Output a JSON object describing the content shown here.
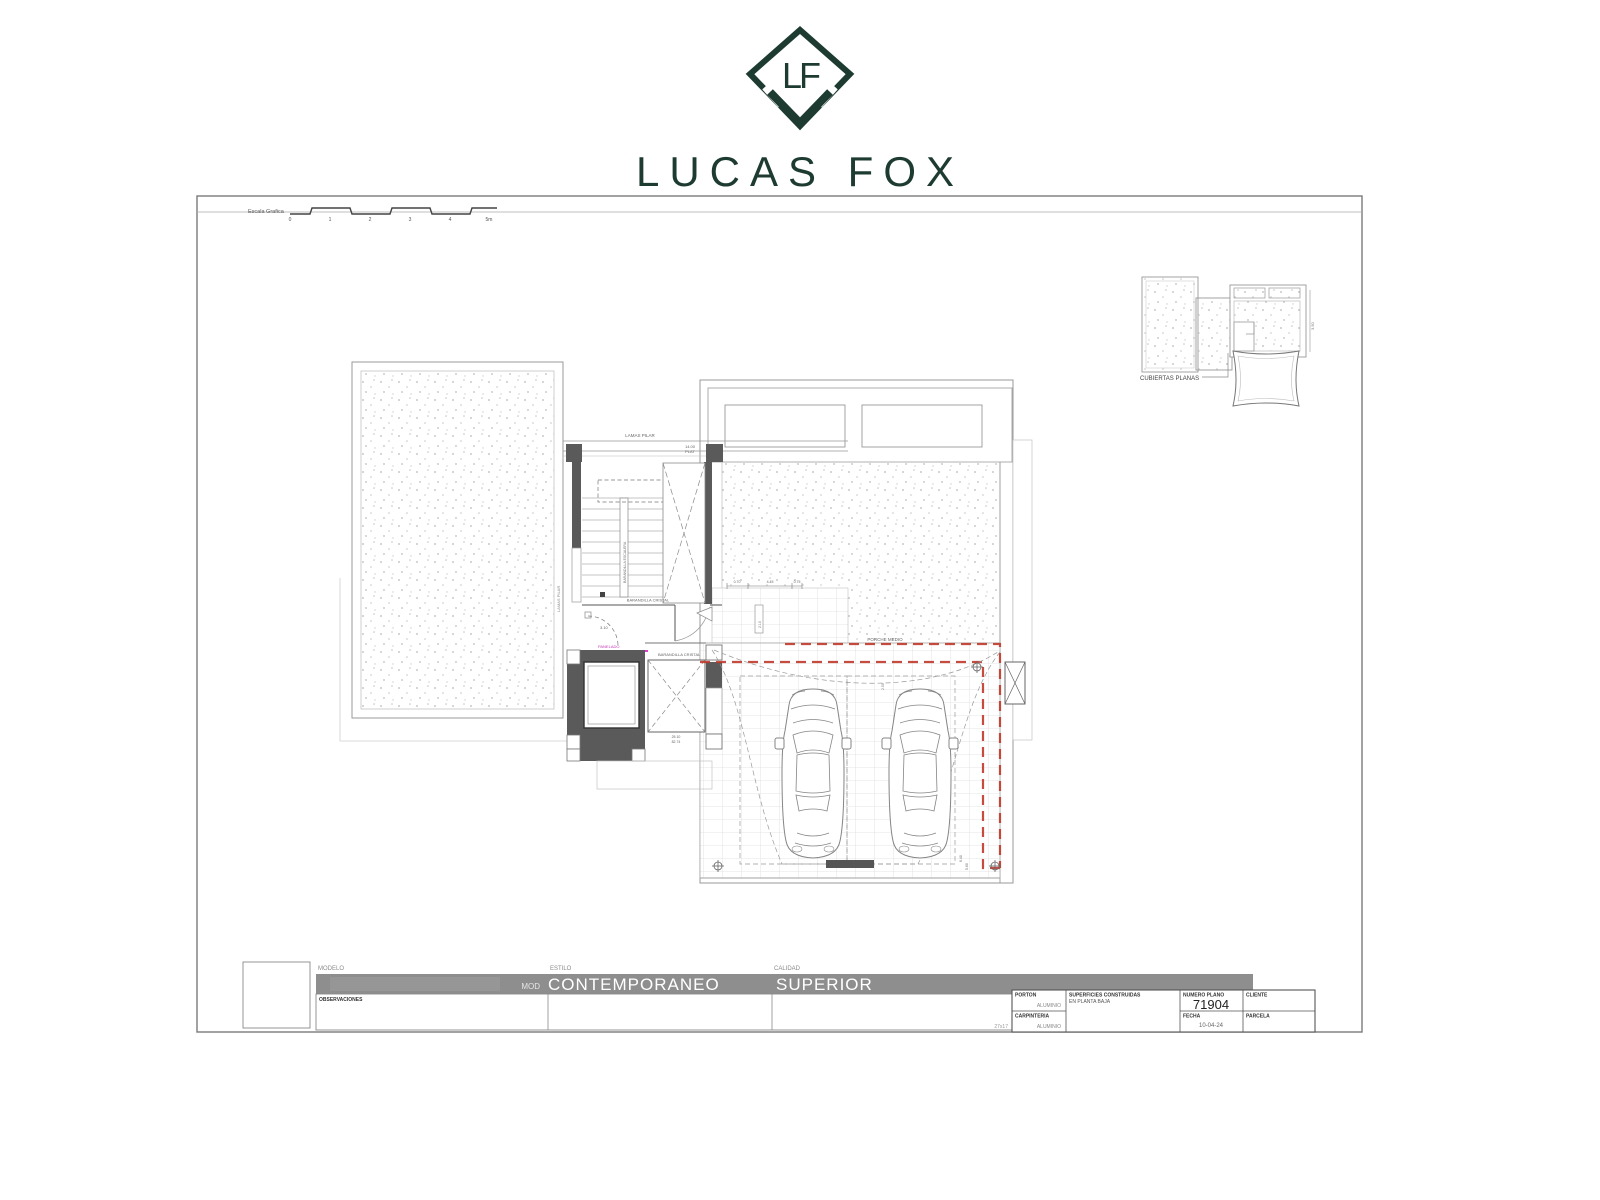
{
  "logo": {
    "monogram": "LF",
    "brand": "LUCAS FOX",
    "tagline": "A Dils company",
    "color": "#1d3b31"
  },
  "scale_bar": {
    "label": "Escala Grafica",
    "ticks": [
      "0",
      "1",
      "2",
      "3",
      "4",
      "5m"
    ]
  },
  "roof_inset": {
    "label": "CUBIERTAS PLANAS",
    "dim": "3.50"
  },
  "plan": {
    "lamas_pilar_top": "LAMAS PILAR",
    "plat_dim": "14.00",
    "plat": "PLAT",
    "lamas_pilar_side": "LAMAS PILAR",
    "barandilla_escalera": "BARANDILLA ESCALERA",
    "barandilla_cristal_1": "BARANDILLA CRISTAL",
    "barandilla_cristal_2": "BARANDILLA CRISTAL",
    "panelado": "PANELADO",
    "door_dim": "3.10",
    "entry_dims": [
      "0.70",
      "4.45",
      "0.75"
    ],
    "entry_v_dim": "2.10",
    "shaft_dim_1": "25.10",
    "shaft_dim_2": "82.74",
    "porche_medio": "PORCHE MEDIO",
    "porch_v_dim": "2.50",
    "corner_dim_1": "6.40",
    "corner_dim_2": "5.60",
    "colors": {
      "red_dashed": "#c0392b",
      "magenta_panel": "#e33fd1",
      "wall_fill": "#5a5a5a"
    }
  },
  "title_block": {
    "labels": {
      "modelo": "MODELO",
      "estilo": "ESTILO",
      "calidad": "CALIDAD"
    },
    "bar": {
      "prefix": "MOD",
      "style": "CONTEMPORANEO",
      "quality": "SUPERIOR",
      "bar_color": "#8e8e8e"
    },
    "observations": "OBSERVACIONES",
    "porton_label": "PORTON",
    "porton_value": "ALUMINIO",
    "carpinteria_label": "CARPINTERIA",
    "carpinteria_value": "ALUMINIO",
    "superficies_label1": "SUPERFICIES CONSTRUIDAS",
    "superficies_label2": "EN PLANTA BAJA",
    "numero_plano_label": "NUMERO PLANO",
    "numero_plano_value": "71904",
    "fecha_label": "FECHA",
    "fecha_value": "10-04-24",
    "cliente_label": "CLIENTE",
    "parcela_label": "PARCELA",
    "corner_note": "27x17"
  }
}
